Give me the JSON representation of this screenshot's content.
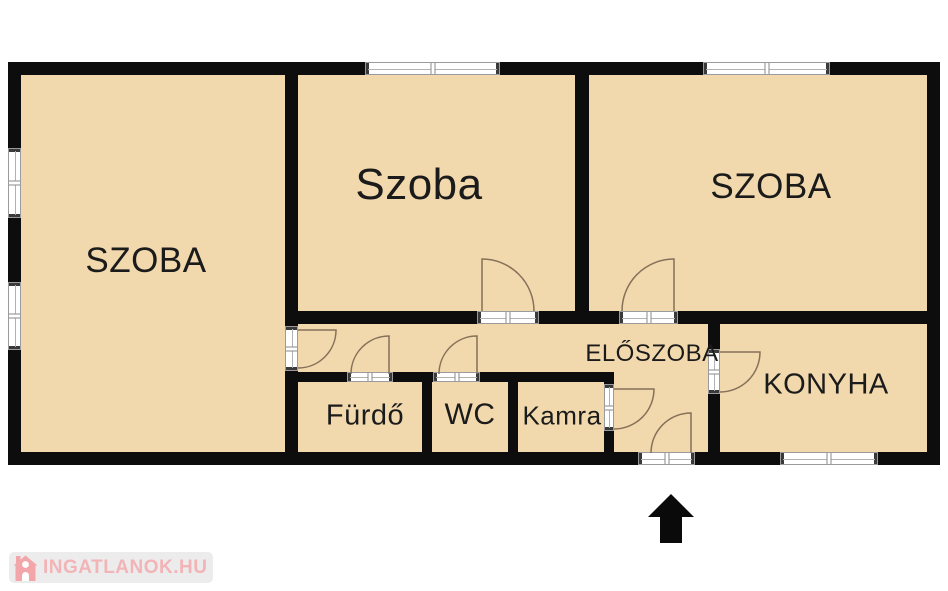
{
  "floorplan": {
    "rooms": [
      {
        "name": "szoba-left",
        "label": "SZOBA"
      },
      {
        "name": "szoba-middle",
        "label": "Szoba"
      },
      {
        "name": "szoba-right",
        "label": "SZOBA"
      },
      {
        "name": "eloszoba",
        "label": "ELŐSZOBA"
      },
      {
        "name": "konyha",
        "label": "KONYHA"
      },
      {
        "name": "furdo",
        "label": "Fürdő"
      },
      {
        "name": "wc",
        "label": "WC"
      },
      {
        "name": "kamra",
        "label": "Kamra"
      }
    ],
    "colors": {
      "room_fill": "#f2d9ad",
      "wall": "#0d0d0d",
      "door_line": "#85715a",
      "window_outline": "#9b9b9b",
      "entrance_arrow": "#0a0a0a",
      "background": "#ffffff"
    }
  },
  "watermark": {
    "text": "INGATLANOK.HU",
    "text_color": "#f2b4b7",
    "icon_color": "#f2a6aa",
    "bg_color": "#ececec"
  }
}
